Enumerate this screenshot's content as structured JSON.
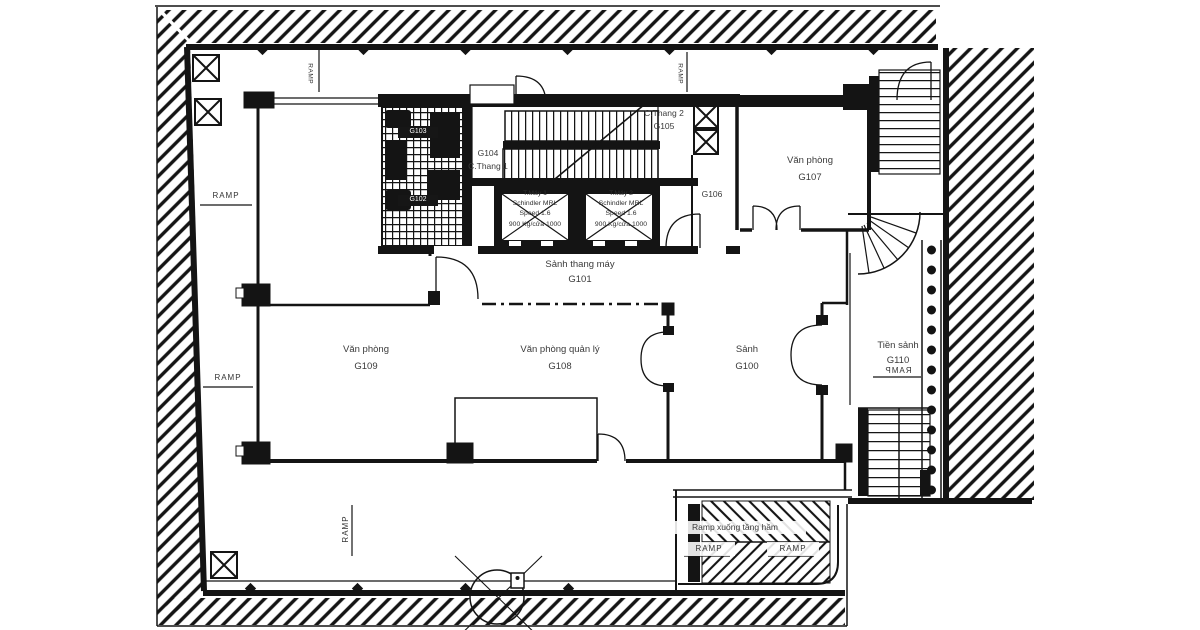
{
  "plan": {
    "rooms": {
      "g100": {
        "name": "Sảnh",
        "code": "G100"
      },
      "g101": {
        "name": "Sảnh thang máy",
        "code": "G101"
      },
      "g102": {
        "code": "G102"
      },
      "g103": {
        "code": "G103"
      },
      "g104": {
        "code": "G104",
        "name": "C.Thang 1"
      },
      "g105": {
        "name": "C.Thang 2",
        "code": "G105"
      },
      "g106": {
        "code": "G106"
      },
      "g107": {
        "name": "Văn phòng",
        "code": "G107"
      },
      "g108": {
        "name": "Văn phòng quản lý",
        "code": "G108"
      },
      "g109": {
        "name": "Văn phòng",
        "code": "G109"
      },
      "g110": {
        "name": "Tiền sảnh",
        "code": "G110"
      }
    },
    "elevators": {
      "lift1": {
        "title": "T.Máy 1",
        "brand": "Schindler MRL",
        "speed": "Speed 1.6",
        "capacity": "900 Kg/cửa 1000"
      },
      "lift2": {
        "title": "T.Máy 2",
        "brand": "Schindler MRL",
        "speed": "Speed 1.6",
        "capacity": "900 Kg/cửa 1000"
      }
    },
    "ramps": {
      "label": "RAMP",
      "basement_label": "Ramp xuống tầng hầm"
    },
    "colors": {
      "line": "#141414",
      "label": "#3a3a3a",
      "background": "#ffffff"
    }
  }
}
